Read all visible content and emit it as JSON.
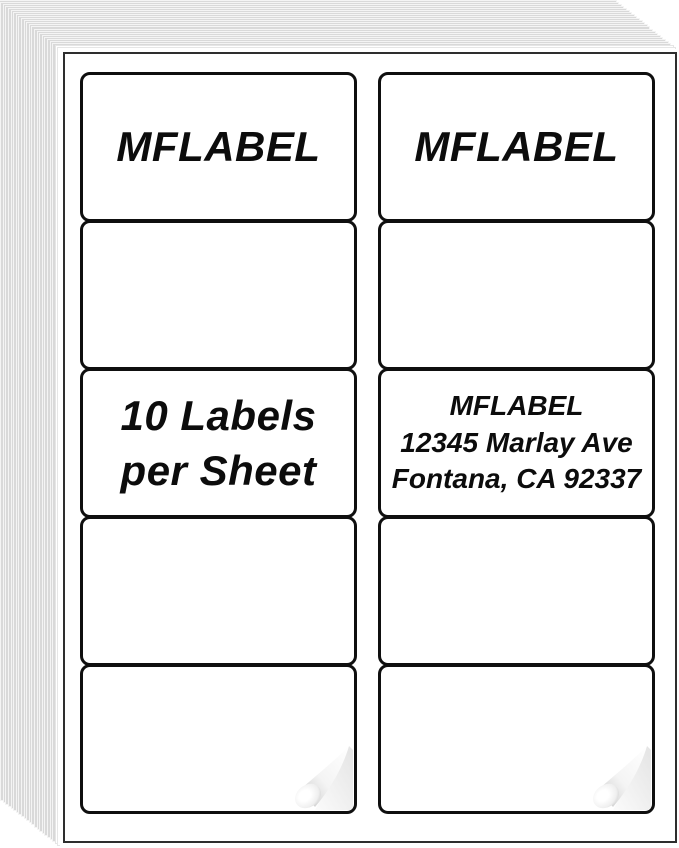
{
  "product": {
    "brand": "MFLABEL"
  },
  "sheet": {
    "grid": {
      "columns": 2,
      "rows": 5
    },
    "columns": [
      {
        "side": "left",
        "cells": [
          {
            "lines": [
              "MFLABEL"
            ]
          },
          {
            "lines": []
          },
          {
            "lines": [
              "10 Labels",
              "per Sheet"
            ]
          },
          {
            "lines": []
          },
          {
            "lines": [],
            "peel": true
          }
        ]
      },
      {
        "side": "right",
        "cells": [
          {
            "lines": [
              "MFLABEL"
            ]
          },
          {
            "lines": []
          },
          {
            "lines": [
              "MFLABEL",
              "12345 Marlay Ave",
              "Fontana, CA 92337"
            ]
          },
          {
            "lines": []
          },
          {
            "lines": [],
            "peel": true
          }
        ]
      }
    ]
  },
  "icons": {
    "page_curl": "page-curl-icon"
  },
  "colors": {
    "text": "#0c0c0c",
    "label_border": "#0f0f0f",
    "sheet_border": "#2e2e2e",
    "stack_sheet_fill": "#d9d9d9",
    "stack_sheet_edge": "#f4f4f4",
    "peel_backing": "#e4e4e4",
    "peel_shade": "#c6c6c6"
  }
}
